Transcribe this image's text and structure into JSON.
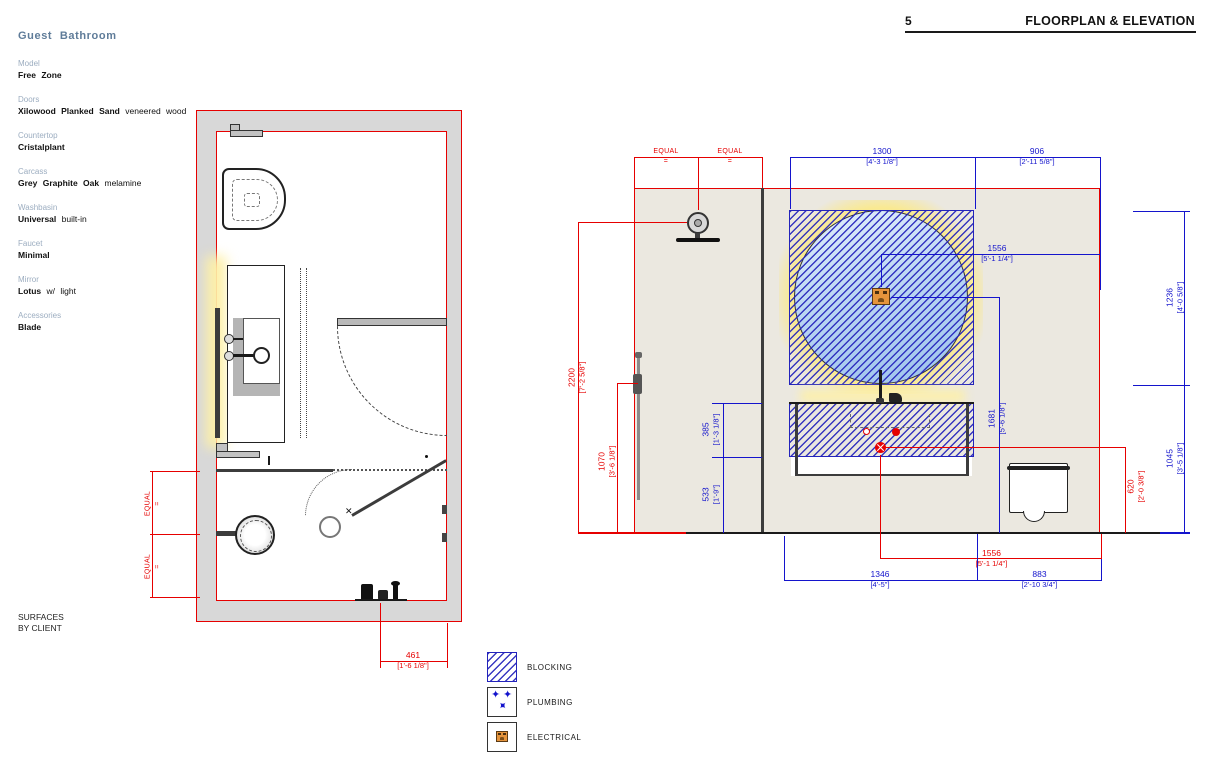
{
  "header": {
    "page_number": "5",
    "title": "FLOORPLAN & ELEVATION"
  },
  "specs": {
    "heading": "Guest Bathroom",
    "items": [
      {
        "label": "Model",
        "bold": "Free Zone",
        "rest": ""
      },
      {
        "label": "Doors",
        "bold": "Xilowood Planked Sand",
        "rest": " veneered wood"
      },
      {
        "label": "Countertop",
        "bold": "Cristalplant",
        "rest": ""
      },
      {
        "label": "Carcass",
        "bold": "Grey Graphite Oak",
        "rest": " melamine"
      },
      {
        "label": "Washbasin",
        "bold": "Universal",
        "rest": " built-in"
      },
      {
        "label": "Faucet",
        "bold": "Minimal",
        "rest": ""
      },
      {
        "label": "Mirror",
        "bold": "Lotus",
        "rest": " w/ light"
      },
      {
        "label": "Accessories",
        "bold": "Blade",
        "rest": ""
      }
    ],
    "footnote_line1": "SURFACES",
    "footnote_line2": "BY CLIENT"
  },
  "floorplan": {
    "dims": {
      "equal1": {
        "mm": "EQUAL",
        "imp": "="
      },
      "equal2": {
        "mm": "EQUAL",
        "imp": "="
      },
      "d461": {
        "mm": "461",
        "imp": "[1'-6 1/8\"]"
      }
    }
  },
  "elevation": {
    "dims": {
      "equal1": {
        "mm": "EQUAL",
        "imp": "="
      },
      "equal2": {
        "mm": "EQUAL",
        "imp": "="
      },
      "d1300": {
        "mm": "1300",
        "imp": "[4'-3 1/8\"]"
      },
      "d906": {
        "mm": "906",
        "imp": "[2'-11 5/8\"]"
      },
      "d1556t": {
        "mm": "1556",
        "imp": "[5'-1 1/4\"]"
      },
      "d1236": {
        "mm": "1236",
        "imp": "[4'-0 5/8\"]"
      },
      "d1045": {
        "mm": "1045",
        "imp": "[3'-5 1/8\"]"
      },
      "d1681": {
        "mm": "1681",
        "imp": "[5'-6 1/8\"]"
      },
      "d385": {
        "mm": "385",
        "imp": "[1'-3 1/8\"]"
      },
      "d533": {
        "mm": "533",
        "imp": "[1'-9\"]"
      },
      "d2200": {
        "mm": "2200",
        "imp": "[7'-2 5/8\"]"
      },
      "d1070": {
        "mm": "1070",
        "imp": "[3'-6 1/8\"]"
      },
      "d620": {
        "mm": "620",
        "imp": "[2'-0 3/8\"]"
      },
      "d1556b": {
        "mm": "1556",
        "imp": "[5'-1 1/4\"]"
      },
      "d1346": {
        "mm": "1346",
        "imp": "[4'-5\"]"
      },
      "d883": {
        "mm": "883",
        "imp": "[2'-10 3/4\"]"
      }
    }
  },
  "legend": {
    "items": [
      {
        "label": "BLOCKING"
      },
      {
        "label": "PLUMBING"
      },
      {
        "label": "ELECTRICAL"
      }
    ]
  },
  "colors": {
    "dim_red": "#e60000",
    "dim_blue": "#1414cc",
    "hatch_blue": "#2323bb",
    "wall_gray": "#d8d8d8",
    "elev_wall": "#ebe8e0",
    "glow_yellow": "#fdf0a8",
    "outlet_orange": "#e5943c"
  }
}
